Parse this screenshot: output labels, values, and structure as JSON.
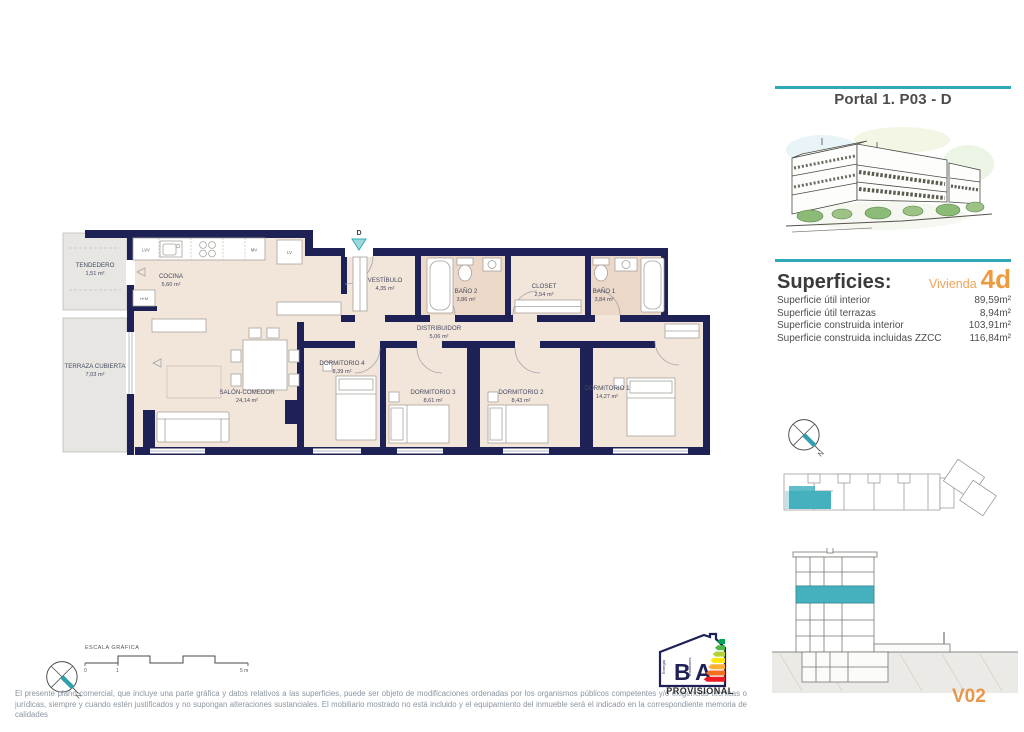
{
  "colors": {
    "teal": "#2fa9b7",
    "orange": "#ee9b3f",
    "wall_navy": "#1d2155",
    "floor_beige": "#f2e5da",
    "bath_beige": "#ecd8c8",
    "terrace_gray": "#e7e6e3",
    "highlight_unit_teal": "#45b1bf"
  },
  "portal": {
    "title": "Portal 1. P03 - D"
  },
  "superficies": {
    "title": "Superficies:",
    "vivienda_label": "Vivienda",
    "vivienda_code": "4d",
    "rows": [
      {
        "label": "Superficie útil interior",
        "value": "89,59m²"
      },
      {
        "label": "Superficie útil terrazas",
        "value": "8,94m²"
      },
      {
        "label": "Superficie construida interior",
        "value": "103,91m²"
      },
      {
        "label": "Superficie construida incluidas ZZCC",
        "value": "116,84m²"
      }
    ]
  },
  "plan": {
    "entrance_label": "D",
    "rooms": {
      "tendedero": {
        "name": "TENDEDERO",
        "area": "1,51 m²"
      },
      "cocina": {
        "name": "COCINA",
        "area": "5,60 m²"
      },
      "terraza": {
        "name": "TERRAZA CUBIERTA",
        "area": "7,03 m²"
      },
      "salon": {
        "name": "SALÓN-COMEDOR",
        "area": "24,14 m²"
      },
      "vestibulo": {
        "name": "VESTÍBULO",
        "area": "4,35 m²"
      },
      "bano2": {
        "name": "BAÑO 2",
        "area": "3,86 m²"
      },
      "closet": {
        "name": "CLOSET",
        "area": "2,54 m²"
      },
      "bano1": {
        "name": "BAÑO 1",
        "area": "3,84 m²"
      },
      "distribuidor": {
        "name": "DISTRIBUIDOR",
        "area": "5,06 m²"
      },
      "dorm4": {
        "name": "DORMITORIO 4",
        "area": "8,39 m²"
      },
      "dorm3": {
        "name": "DORMITORIO 3",
        "area": "8,61 m²"
      },
      "dorm2": {
        "name": "DORMITORIO 2",
        "area": "8,43 m²"
      },
      "dorm1": {
        "name": "DORMITORIO 1",
        "area": "14,27 m²"
      }
    },
    "appliances": {
      "lvv": "LVV",
      "mv": "MV",
      "lv": "LV",
      "hm": "H+M"
    }
  },
  "scalebar": {
    "title": "ESCALA GRÁFICA",
    "tick0": "0",
    "tick1": "1",
    "tick5": "5 m"
  },
  "compass": {
    "north": "N"
  },
  "energy": {
    "letter_energy": "B",
    "letter_emissions": "A",
    "label_energy": "Energía",
    "label_emissions": "Emisiones",
    "status": "PROVISIONAL"
  },
  "sheet_code": "V02",
  "disclaimer": "El presente plano comercial, que incluye una parte gráfica y datos relativos a las superficies, puede ser objeto de modificaciones ordenadas por los organismos públicos competentes y/o exigencias técnicas o jurídicas, siempre y cuando estén justificados y no supongan alteraciones sustanciales. El mobiliario mostrado no está incluido y el equipamiento del inmueble será el indicado en la correspondiente memoria de calidades"
}
